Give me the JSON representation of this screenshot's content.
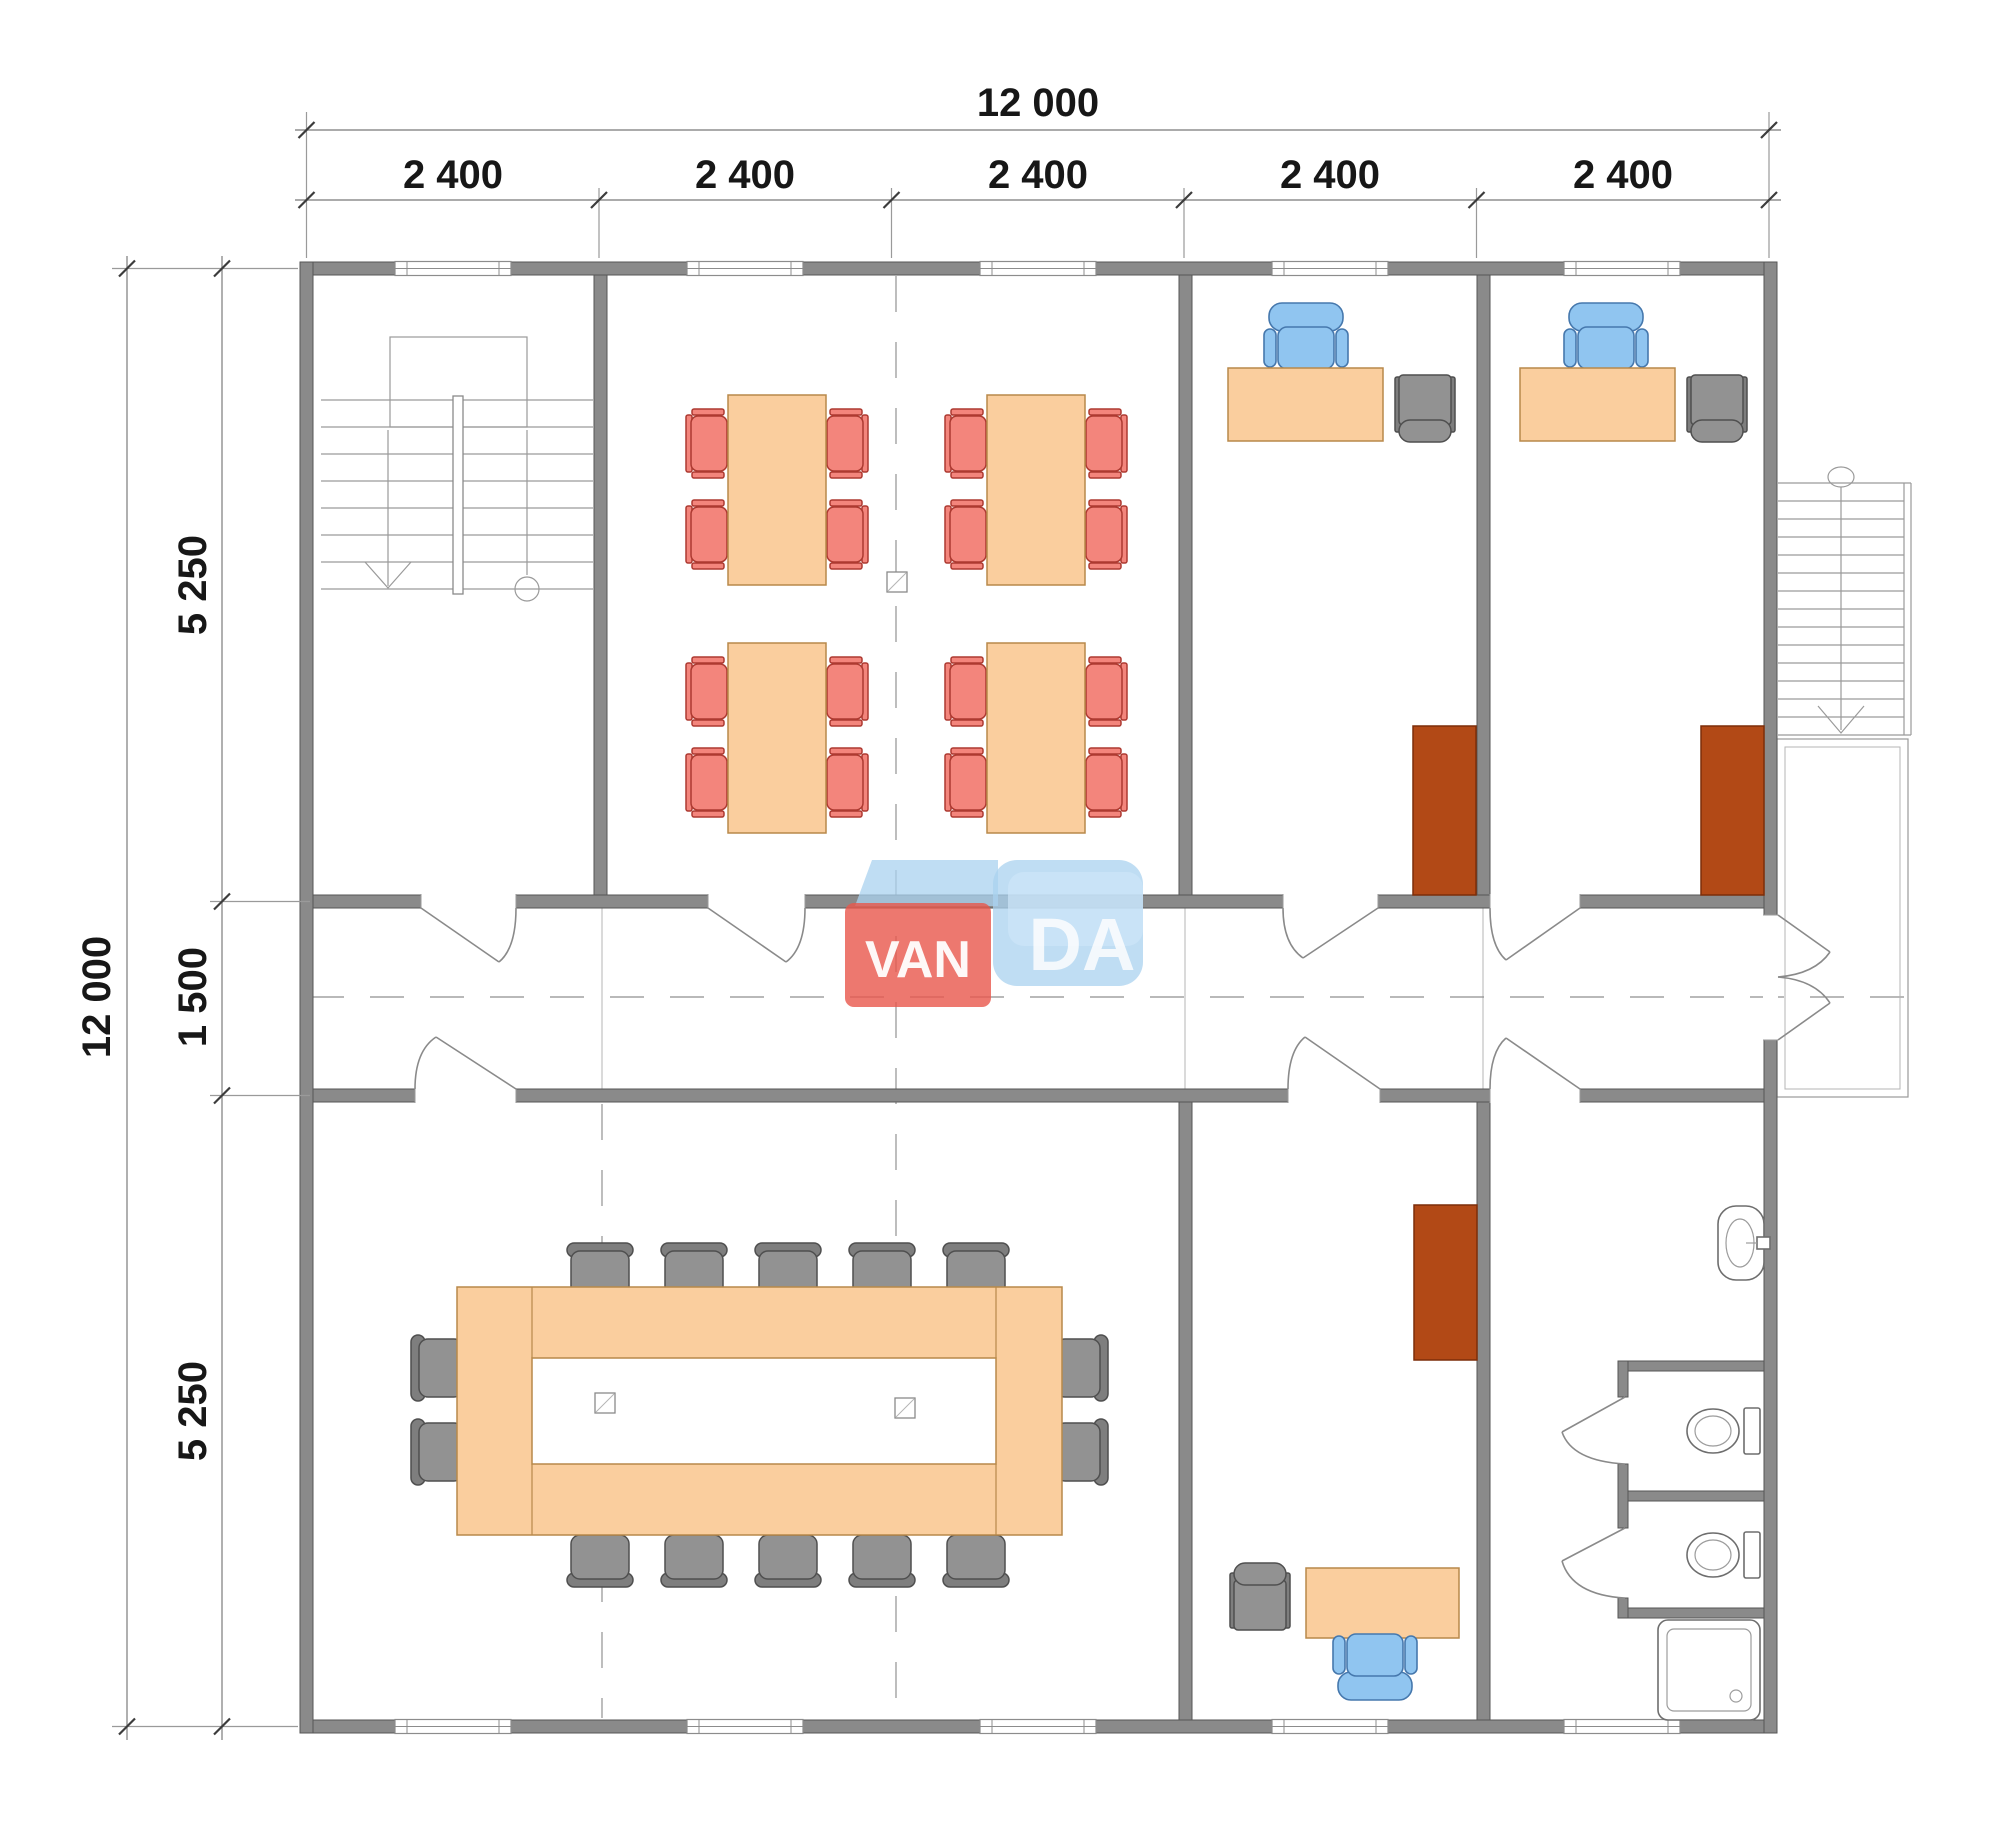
{
  "palette": {
    "bg": "#ffffff",
    "wall": "#8a8a8a",
    "wall_edge": "#565656",
    "orange": "#face9e",
    "orange_border": "#b8894a",
    "chair_red": "#f3857c",
    "chair_red_border": "#ad3a31",
    "chair_blue": "#90c5f0",
    "chair_blue_border": "#4678ad",
    "gray": "#929292",
    "gray_border": "#4f4f4f",
    "cabinet": "#b24916",
    "cabinet_border": "#7c2d08",
    "logo_red": "#e9564b",
    "logo_blue": "#a9d2ef",
    "logo_text": "#ffffff"
  },
  "dimensions": {
    "top_total": "12 000",
    "top_bays": [
      "2 400",
      "2 400",
      "2 400",
      "2 400",
      "2 400"
    ],
    "left_total": "12 000",
    "left_segments": [
      "5 250",
      "1 500",
      "5 250"
    ]
  },
  "logo": {
    "van": "VAN",
    "da": "DA"
  }
}
